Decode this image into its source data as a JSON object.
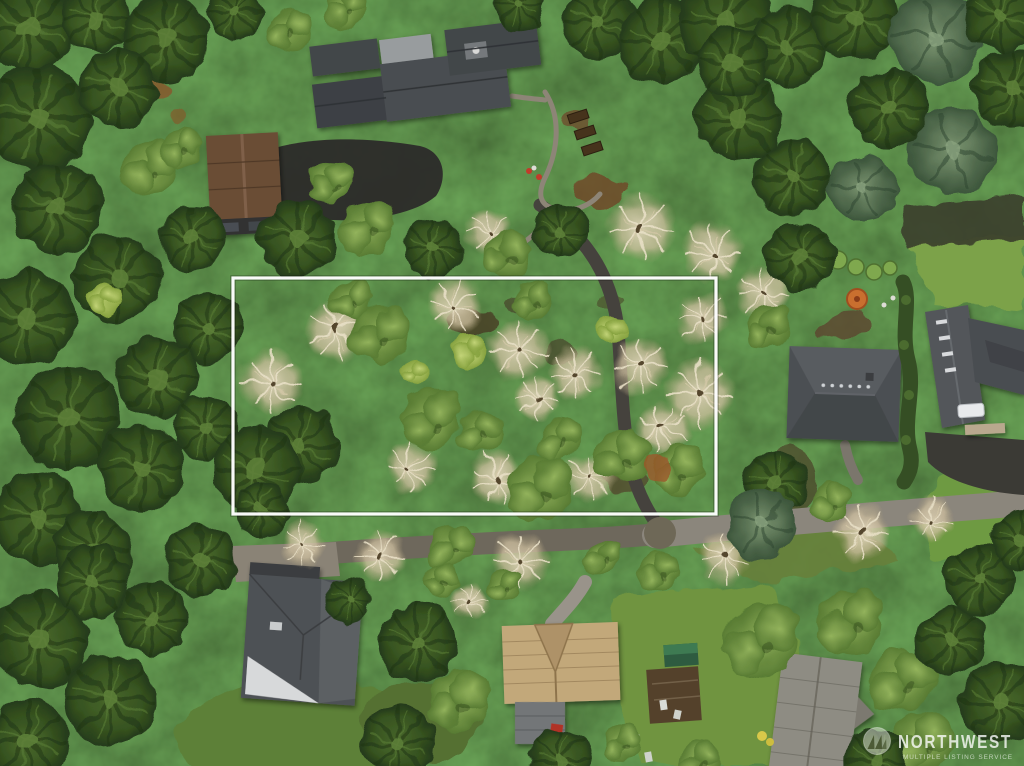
{
  "meta": {
    "image_type": "aerial-photograph",
    "subject": "Overhead drone photo of a forested residential neighborhood with a vacant treed lot outlined in white"
  },
  "watermark": {
    "brand": "NORTHWEST",
    "tagline": "MULTIPLE LISTING SERVICE",
    "logo_icon": "evergreen-trees-badge-icon",
    "text_color": "#ffffff"
  },
  "boundary": {
    "label": "property boundary outline",
    "shape": "rectangle",
    "stroke_color": "#ffffff"
  },
  "palette": {
    "conifer_dark": "#24391a",
    "conifer_mid": "#4c6b2d",
    "deciduous_green": "#93b35c",
    "lime_green": "#c3d478",
    "bare_tree_tan": "#d6cbb0",
    "lawn_green": "#719a44",
    "soil_brown": "#5c4530",
    "road_asphalt": "#45423d",
    "road_gravel": "#8b867c",
    "roof_dark_gray": "#4c4f53",
    "roof_brown": "#6b4e36",
    "roof_tan": "#c2a87a",
    "boundary_white": "#ffffff",
    "umbrella_orange": "#c96f2f"
  },
  "scene": {
    "features": [
      "dense forest canopy of conifers and bare winter trees",
      "white rectangular boundary around treed vacant lot (center)",
      "modern dark-roof house with garden paths and raised beds (top center)",
      "brown-roof garage with asphalt driveway (upper left)",
      "hip-roof gray house (right)",
      "large gray-roof house with white car and hedge (far right)",
      "orange patio umbrella and lawns (upper right)",
      "winding driveway through the lot to the road",
      "neighborhood road across the bottom and along the right",
      "gray-roof house with white gable (bottom left)",
      "tan-roof house with garage, shed and garden beds (bottom center)",
      "partially visible roof (bottom right)",
      "NWMLS watermark badge (bottom right)"
    ]
  }
}
